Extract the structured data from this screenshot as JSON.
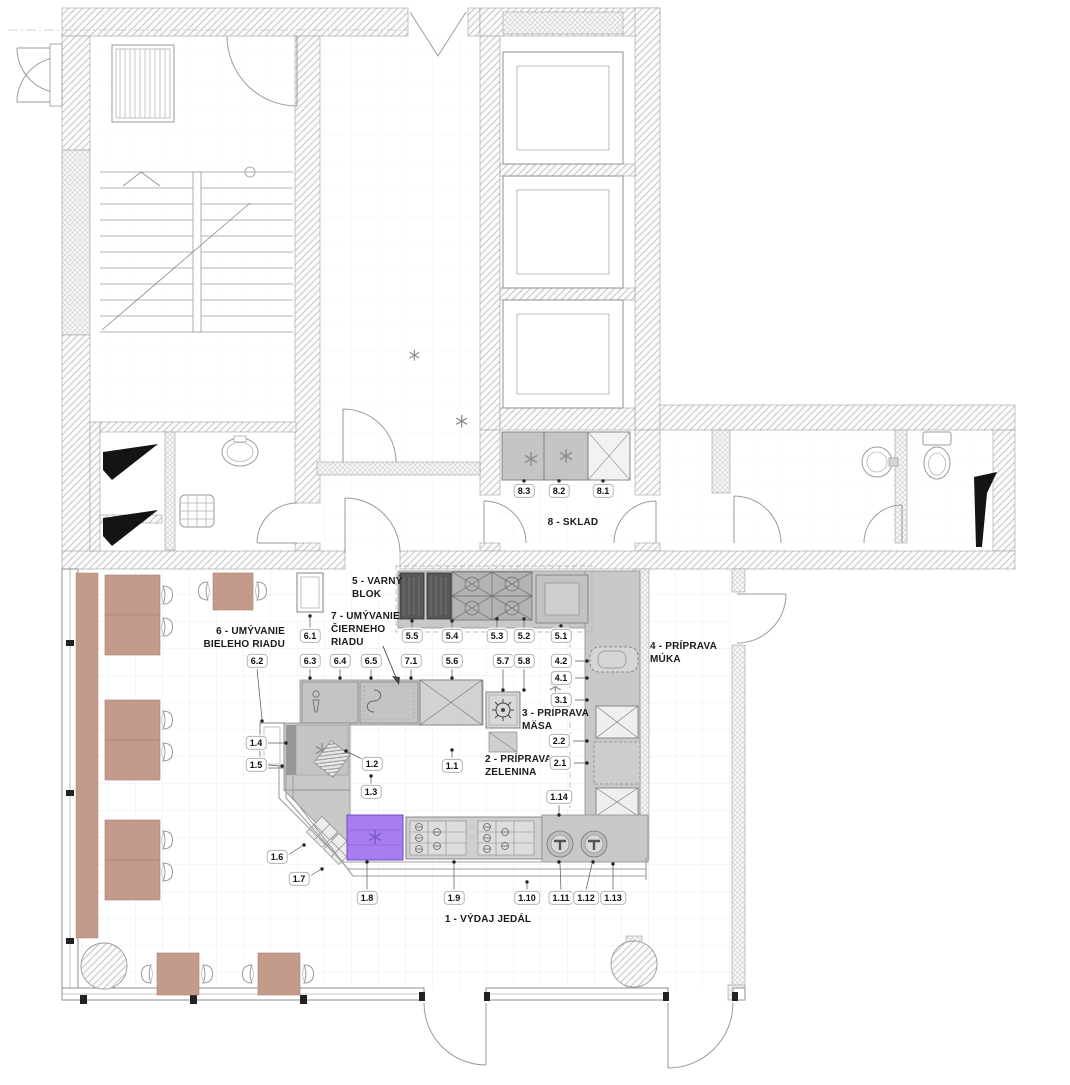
{
  "plan": {
    "areas": [
      {
        "id": "varny-blok",
        "text": "5 - VARNÝ\nBLOK",
        "x": 352,
        "y": 575,
        "align": "left"
      },
      {
        "id": "umyvanie-cierneho-riadu",
        "text": "7 - UMÝVANIE\nČIERNEHO\nRIADU",
        "x": 331,
        "y": 610,
        "align": "left"
      },
      {
        "id": "umyvanie-bieleho-riadu",
        "text": "6 - UMÝVANIE\nBIELEHO RIADU",
        "x": 285,
        "y": 625,
        "align": "right"
      },
      {
        "id": "sklad",
        "text": "8 - SKLAD",
        "x": 573,
        "y": 516,
        "align": "center"
      },
      {
        "id": "priprava-muka",
        "text": "4 - PRÍPRAVA\nMÚKA",
        "x": 650,
        "y": 640,
        "align": "left"
      },
      {
        "id": "priprava-masa",
        "text": "3 - PRÍPRAVA\nMÄSA",
        "x": 522,
        "y": 707,
        "align": "left"
      },
      {
        "id": "priprava-zelenina",
        "text": "2 - PRÍPRAVA\nZELENINA",
        "x": 485,
        "y": 753,
        "align": "left"
      },
      {
        "id": "vydaj-jedal",
        "text": "1 - VÝDAJ JEDÁL",
        "x": 488,
        "y": 913,
        "align": "center"
      }
    ],
    "tags": [
      {
        "label": "8.3",
        "x": 524,
        "y": 491
      },
      {
        "label": "8.2",
        "x": 559,
        "y": 491
      },
      {
        "label": "8.1",
        "x": 603,
        "y": 491
      },
      {
        "label": "6.1",
        "x": 310,
        "y": 636
      },
      {
        "label": "5.5",
        "x": 412,
        "y": 636
      },
      {
        "label": "5.4",
        "x": 452,
        "y": 636
      },
      {
        "label": "5.3",
        "x": 497,
        "y": 636
      },
      {
        "label": "5.2",
        "x": 524,
        "y": 636
      },
      {
        "label": "5.1",
        "x": 561,
        "y": 636
      },
      {
        "label": "6.2",
        "x": 257,
        "y": 661
      },
      {
        "label": "6.3",
        "x": 310,
        "y": 661
      },
      {
        "label": "6.4",
        "x": 340,
        "y": 661
      },
      {
        "label": "6.5",
        "x": 371,
        "y": 661
      },
      {
        "label": "7.1",
        "x": 411,
        "y": 661
      },
      {
        "label": "5.6",
        "x": 452,
        "y": 661
      },
      {
        "label": "5.7",
        "x": 503,
        "y": 661
      },
      {
        "label": "5.8",
        "x": 524,
        "y": 661
      },
      {
        "label": "4.2",
        "x": 561,
        "y": 661
      },
      {
        "label": "4.1",
        "x": 561,
        "y": 678
      },
      {
        "label": "3.1",
        "x": 561,
        "y": 700
      },
      {
        "label": "2.2",
        "x": 559,
        "y": 741
      },
      {
        "label": "2.1",
        "x": 560,
        "y": 763
      },
      {
        "label": "1.14",
        "x": 559,
        "y": 797
      },
      {
        "label": "1.4",
        "x": 256,
        "y": 743
      },
      {
        "label": "1.5",
        "x": 256,
        "y": 765
      },
      {
        "label": "1.2",
        "x": 372,
        "y": 764
      },
      {
        "label": "1.1",
        "x": 452,
        "y": 766
      },
      {
        "label": "1.3",
        "x": 371,
        "y": 792
      },
      {
        "label": "1.6",
        "x": 277,
        "y": 857
      },
      {
        "label": "1.7",
        "x": 299,
        "y": 879
      },
      {
        "label": "1.8",
        "x": 367,
        "y": 898
      },
      {
        "label": "1.9",
        "x": 454,
        "y": 898
      },
      {
        "label": "1.10",
        "x": 527,
        "y": 898
      },
      {
        "label": "1.11",
        "x": 561,
        "y": 898
      },
      {
        "label": "1.12",
        "x": 586,
        "y": 898
      },
      {
        "label": "1.13",
        "x": 613,
        "y": 898
      }
    ],
    "colors": {
      "counter_gray": "#c8c8c8",
      "equipment_dark": "#565656",
      "table_brown": "#c49a8b",
      "cold_unit_purple": "#a67ef0",
      "wall_line": "#8f8f8f"
    }
  }
}
